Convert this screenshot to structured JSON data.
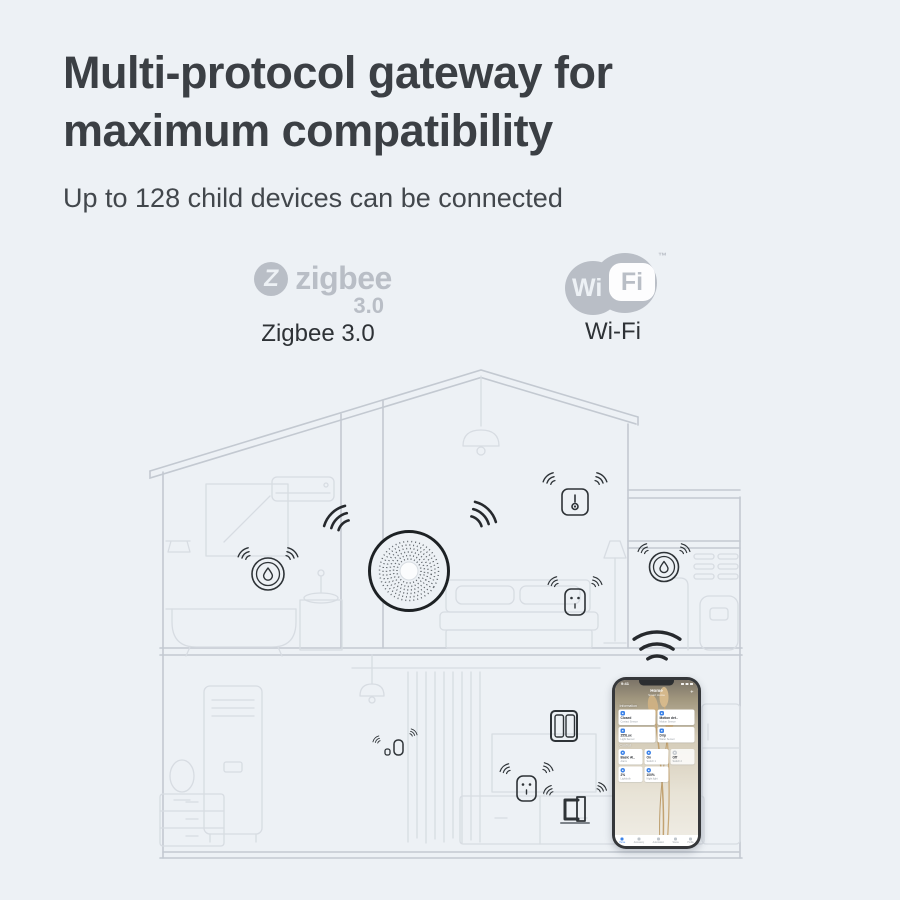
{
  "header": {
    "title_line1": "Multi-protocol gateway for",
    "title_line2": "maximum compatibility",
    "subtitle": "Up to 128 child devices can be connected"
  },
  "protocols": {
    "zigbee": {
      "logo_letter": "Z",
      "logo_word": "zigbee",
      "logo_version": "3.0",
      "label": "Zigbee 3.0"
    },
    "wifi": {
      "logo_wi": "Wi",
      "logo_fi": "Fi",
      "trademark": "™",
      "label": "Wi-Fi"
    }
  },
  "colors": {
    "background": "#edf1f5",
    "title": "#3b3f44",
    "logo_gray": "#b9bec6",
    "line_wall": "#c3c9d1",
    "line_furniture": "#d7dce2",
    "device_ink": "#2e3337",
    "app_blue": "#3b82e8"
  },
  "illustration": {
    "device_icons": [
      "zigbee-gateway-hub",
      "water-leak-sensor",
      "temperature-sensor",
      "smart-plug",
      "water-leak-sensor",
      "wall-switch-double-rocker",
      "wireless-mini-switch",
      "smart-plug",
      "curtain-controller",
      "wifi-signal-arcs",
      "smartphone-app"
    ]
  },
  "phone_app": {
    "status": {
      "time": "9:41"
    },
    "header_title": "Home",
    "header_subtitle": "Smart Home",
    "plus_icon": "+",
    "section_information": "Information",
    "section_control": "Control",
    "info_cards": [
      {
        "value": "Closed",
        "name": "Contact Sensor"
      },
      {
        "value": "Motion det..",
        "name": "Motion Sensor"
      },
      {
        "value": "255Lux",
        "name": "Light Sensor"
      },
      {
        "value": "Drip",
        "name": "Water Sensor"
      }
    ],
    "control_cards": [
      {
        "value": "Basic Al..",
        "name": "Alarm"
      },
      {
        "value": "On",
        "name": "Switch 1"
      },
      {
        "value": "Off",
        "name": "Switch 2"
      },
      {
        "value": "2%",
        "name": "Lightbulb"
      },
      {
        "value": "100%",
        "name": "Night light"
      }
    ],
    "nav_items": [
      {
        "label": "Home"
      },
      {
        "label": "Accessory"
      },
      {
        "label": "Automation"
      },
      {
        "label": "Scene"
      },
      {
        "label": "Profile"
      }
    ]
  }
}
